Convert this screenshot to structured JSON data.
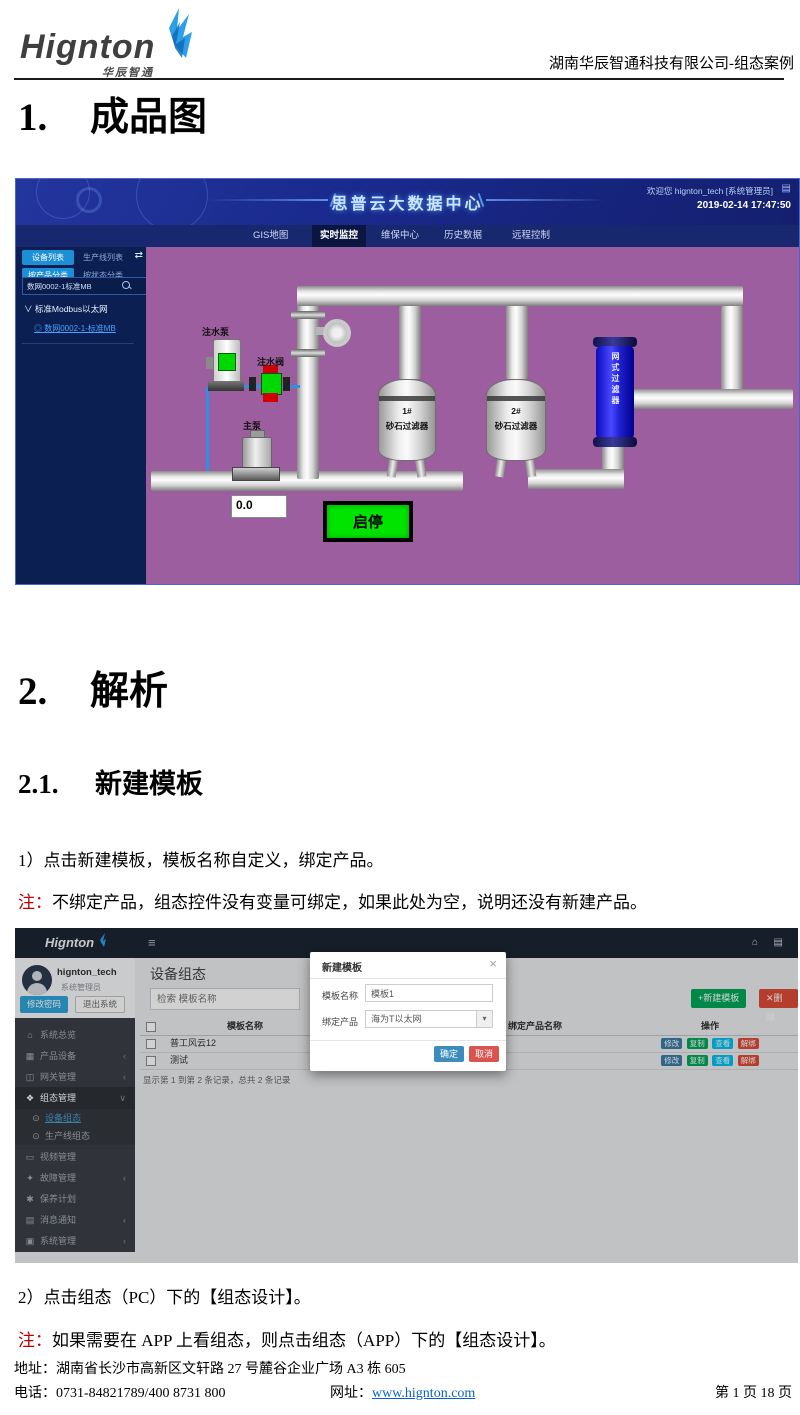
{
  "doc": {
    "logo": {
      "name": "Hignton",
      "sub": "华辰智通"
    },
    "header_right": "湖南华辰智通科技有限公司-组态案例",
    "h1_num": "1.",
    "h1_text": "成品图",
    "h2_num": "2.",
    "h2_text": "解析",
    "h21_num": "2.1.",
    "h21_text": "新建模板",
    "para1": "1）点击新建模板，模板名称自定义，绑定产品。",
    "note1_tag": "注：",
    "note1_text": "不绑定产品，组态控件没有变量可绑定，如果此处为空，说明还没有新建产品。",
    "para2": "2）点击组态（PC）下的【组态设计】。",
    "note2_tag": "注：",
    "note2_text": "如果需要在 APP 上看组态，则点击组态（APP）下的【组态设计】。",
    "footer": {
      "address": "地址：湖南省长沙市高新区文轩路 27 号麓谷企业广场 A3 栋 605",
      "phone": "电话：0731-84821789/400 8731 800",
      "site_label": "网址：",
      "site_url": "www.hignton.com",
      "page": "第 1 页 18 页"
    }
  },
  "scada": {
    "title": "思普云大数据中心",
    "welcome": "欢迎您 hignton_tech [系统管理员]",
    "datetime": "2019-02-14 17:47:50",
    "nav": [
      {
        "label": "GIS地图"
      },
      {
        "label": "实时监控"
      },
      {
        "label": "维保中心"
      },
      {
        "label": "历史数据"
      },
      {
        "label": "远程控制"
      }
    ],
    "sidebar": {
      "tab_device": "设备列表",
      "tab_line": "生产线列表",
      "tab_product": "按产品分类",
      "tab_status": "按状态分类",
      "search_value": "数网0002-1标准MB",
      "tree_root": "标准Modbus以太网",
      "tree_leaf": "数网0002-1-标准MB"
    },
    "icons": {
      "swap": "⇄",
      "menu": "▤",
      "chevron_down": "∨",
      "leaf": "◎"
    },
    "diagram": {
      "pump_injection": "注水泵",
      "valve_injection": "注水阀",
      "pump_main": "主泵",
      "tank1_no": "1#",
      "tank1_name": "砂石过滤器",
      "tank2_no": "2#",
      "tank2_name": "砂石过滤器",
      "mesh_filter": "网式过滤器",
      "reading": "0.0",
      "start_stop": "启停"
    },
    "colors": {
      "canvas": "#9c5e9e",
      "accent": "#1d8fd6",
      "run_green": "#00e400"
    }
  },
  "admin": {
    "logo": "Hignton",
    "icons": {
      "hamburger": "≡",
      "home": "⌂",
      "doc": "▤",
      "chevron_left": "‹",
      "chevron_down": "∨",
      "dropdown": "▾",
      "plus": "+",
      "x": "✕"
    },
    "user": {
      "name": "hignton_tech",
      "role": "系统管理员",
      "change_pwd": "修改密码",
      "logout": "退出系统"
    },
    "menu": [
      {
        "label": "系统总览",
        "icon": "⌂"
      },
      {
        "label": "产品设备",
        "icon": "▦"
      },
      {
        "label": "网关管理",
        "icon": "◫"
      },
      {
        "label": "组态管理",
        "icon": "❖"
      },
      {
        "label": "设备组态",
        "icon": "⊙"
      },
      {
        "label": "生产线组态",
        "icon": "⊙"
      },
      {
        "label": "视频管理",
        "icon": "▭"
      },
      {
        "label": "故障管理",
        "icon": "✦"
      },
      {
        "label": "保养计划",
        "icon": "✱"
      },
      {
        "label": "消息通知",
        "icon": "▤"
      },
      {
        "label": "系统管理",
        "icon": "▣"
      }
    ],
    "content": {
      "title": "设备组态",
      "search_placeholder": "检索 模板名称",
      "btn_new": "新建模板",
      "btn_delete": "删除",
      "table": {
        "headers": [
          "模板名称",
          "组态（PC）",
          "绑定产品名称",
          "操作"
        ],
        "rows": [
          {
            "name": "普工风云12",
            "link": "组态设计"
          },
          {
            "name": "测试",
            "link": "组态设计"
          }
        ],
        "actions": [
          "修改",
          "复制",
          "查看",
          "解绑"
        ],
        "summary": "显示第 1 到第 2 条记录，总共 2 条记录"
      }
    },
    "modal": {
      "title": "新建模板",
      "close": "×",
      "name_label": "模板名称",
      "name_value": "模板1",
      "product_label": "绑定产品",
      "product_value": "海为T以太网",
      "ok": "确定",
      "cancel": "取消"
    }
  }
}
